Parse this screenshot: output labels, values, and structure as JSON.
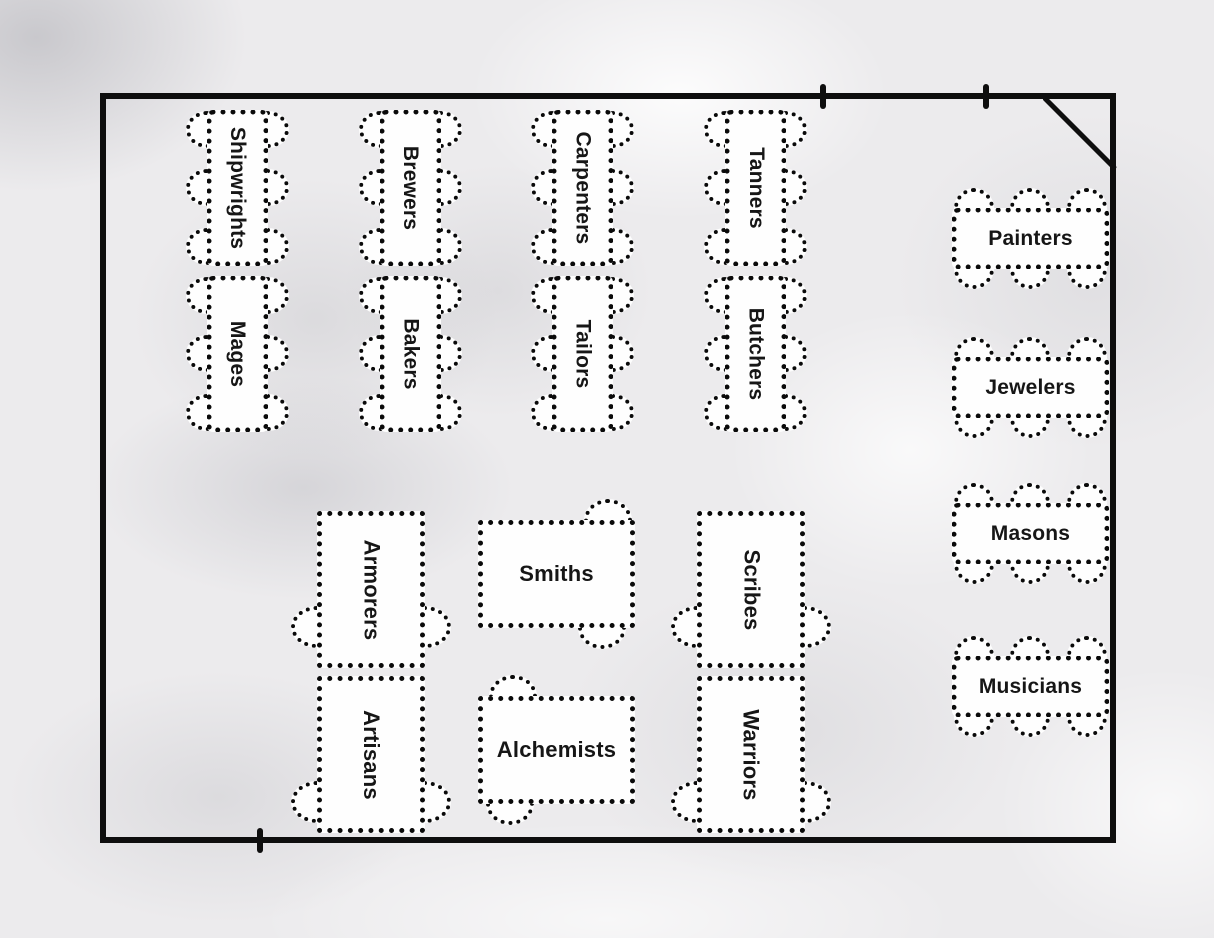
{
  "palette": {
    "wall": "#0e0e0e",
    "table_border": "#0a0a0a",
    "table_fill": "#fefefe",
    "label_text": "#161616",
    "floor_background": "#ecebed"
  },
  "room": {
    "shape": "rectangle",
    "top_wall_tick_count": 2,
    "bottom_wall_tick_count": 1,
    "corner_diagonal": "top-right"
  },
  "tables": [
    {
      "label": "Shipwrights",
      "seats": 6,
      "orientation": "vertical"
    },
    {
      "label": "Mages",
      "seats": 6,
      "orientation": "vertical"
    },
    {
      "label": "Brewers",
      "seats": 6,
      "orientation": "vertical"
    },
    {
      "label": "Bakers",
      "seats": 6,
      "orientation": "vertical"
    },
    {
      "label": "Carpenters",
      "seats": 6,
      "orientation": "vertical"
    },
    {
      "label": "Tailors",
      "seats": 6,
      "orientation": "vertical"
    },
    {
      "label": "Tanners",
      "seats": 6,
      "orientation": "vertical"
    },
    {
      "label": "Butchers",
      "seats": 6,
      "orientation": "vertical"
    },
    {
      "label": "Painters",
      "seats": 6,
      "orientation": "horizontal"
    },
    {
      "label": "Jewelers",
      "seats": 6,
      "orientation": "horizontal"
    },
    {
      "label": "Masons",
      "seats": 6,
      "orientation": "horizontal"
    },
    {
      "label": "Musicians",
      "seats": 6,
      "orientation": "horizontal"
    },
    {
      "label": "Armorers",
      "seats": 2,
      "orientation": "vertical"
    },
    {
      "label": "Artisans",
      "seats": 2,
      "orientation": "vertical"
    },
    {
      "label": "Smiths",
      "seats": 2,
      "orientation": "horizontal"
    },
    {
      "label": "Alchemists",
      "seats": 2,
      "orientation": "horizontal"
    },
    {
      "label": "Scribes",
      "seats": 2,
      "orientation": "vertical"
    },
    {
      "label": "Warriors",
      "seats": 2,
      "orientation": "vertical"
    }
  ]
}
